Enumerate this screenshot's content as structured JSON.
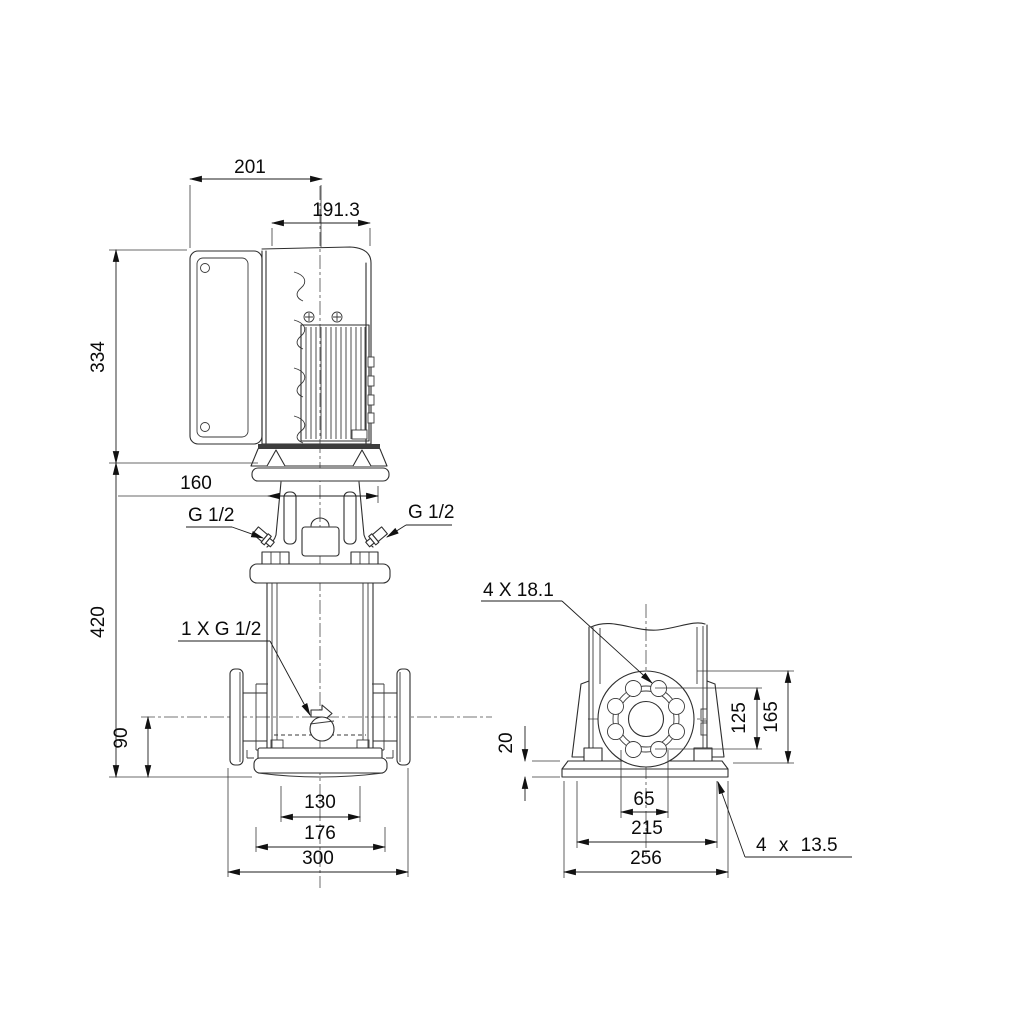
{
  "title": "pump-dimensional-drawing",
  "colors": {
    "background": "#ffffff",
    "line": "#2e2e2e",
    "text": "#0b0b0b"
  },
  "front_view": {
    "dim_motor_depth": "201",
    "dim_motor_width": "191.3",
    "dim_motor_height": "334",
    "dim_head_width": "160",
    "dim_pump_height": "420",
    "dim_port_height": "90",
    "dim_base_inner_width": "130",
    "dim_base_outer_width": "176",
    "dim_port_span": "300",
    "label_vent_left": "G 1/2",
    "label_vent_right": "G 1/2",
    "label_drain": "1 X G 1/2"
  },
  "side_view": {
    "dim_plate_thickness": "20",
    "dim_bolt_circle_height": "125",
    "dim_flange_height": "165",
    "dim_bolt_spacing": "65",
    "dim_base_width": "215",
    "dim_plate_width": "256",
    "label_flange_holes": "4 X 18.1",
    "label_base_holes": "4 x 13.5"
  }
}
